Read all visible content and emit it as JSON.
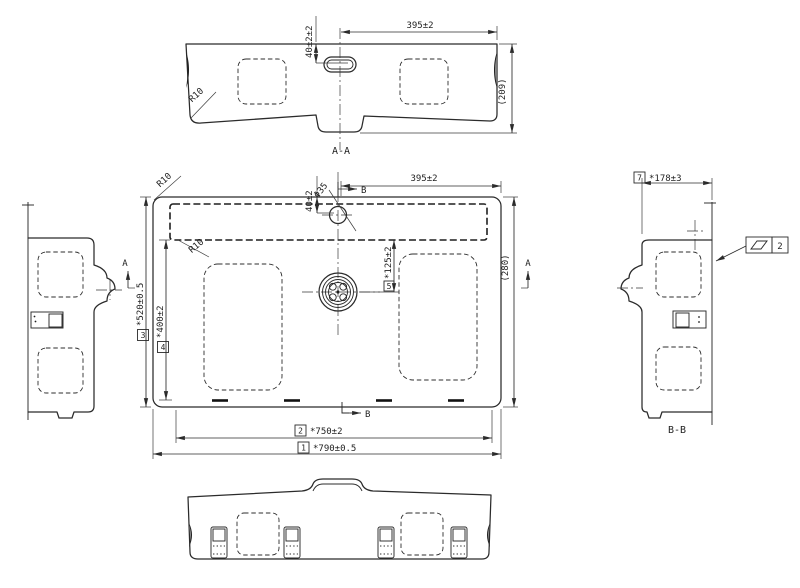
{
  "drawing": {
    "background": "#ffffff",
    "ink": "#2b2b2b",
    "views": {
      "section_aa": {
        "label": "A-A",
        "dim_hole_offset": "40±2±2",
        "dim_hole_to_edge": "395±2",
        "dim_height_ref": "(209)",
        "radius_label": "R10"
      },
      "plan": {
        "dim_faucet_offset": "40±2",
        "dim_faucet_dia": "Φ35",
        "dim_hole_to_edge": "395±2",
        "dim_depth_ref": "(280)",
        "radius_outer": "R10",
        "radius_inner": "R10",
        "dim_drain_offset": "*125±2",
        "dim_drain_offset_no": "5",
        "dim_depth": "*520±0.5",
        "dim_depth_no": "3",
        "dim_depth_inner": "*400±2",
        "dim_depth_inner_no": "4",
        "dim_width_inner": "*750±2",
        "dim_width_inner_no": "2",
        "dim_width": "*790±0.5",
        "dim_width_no": "1",
        "section_a": "A",
        "section_b": "B"
      },
      "section_bb": {
        "label": "B-B",
        "dim_width": "*178±3",
        "dim_width_no": "7",
        "flatness_value": "2"
      }
    }
  }
}
